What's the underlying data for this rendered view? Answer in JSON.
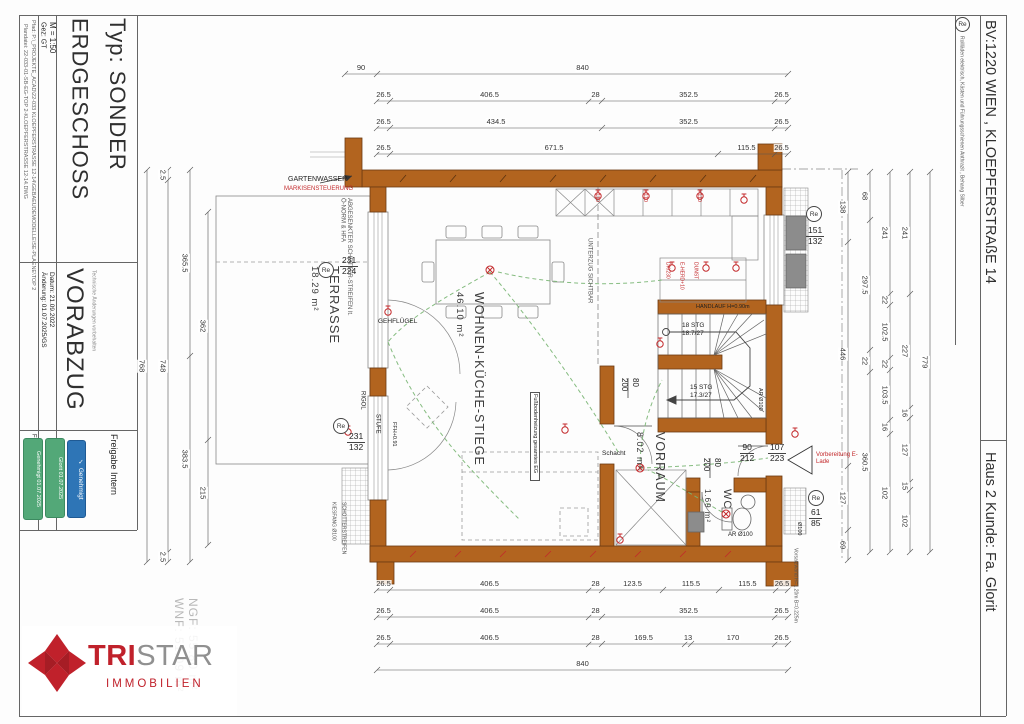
{
  "symbols": {
    "re": "Re"
  },
  "titleblock": {
    "typ": "Typ: SONDER",
    "floor": "ERDGESCHOSS",
    "scale": "M = 1:50",
    "gez": "Gez:  GT",
    "pfad": "Pfad: P:\\_PROJEKTE_ACAD\\22-033 KLOEPFERSTRASSE 12-14\\GEBAEUDEMODELLE\\SE-PLAENE\\TOP 2",
    "plandatei": "Plandatei: 22-033-01-SB-EG-TOP 2-KLOEPFERSTRASSE 12-14.DWG",
    "vorabzug": "VORABZUG",
    "vorabzug_sub": "Technische Änderungen vorbehalten",
    "datum": "Datum: 21.09.2022",
    "aenderung": "Änderung: 01.07.2025/GS",
    "freigabe_kunde": "Freigabe Kunde:",
    "freigabe_intern": "Freigabe Intern",
    "stamp_green_2": "Genehmigt 01.07.2025",
    "stamp_green_1": "Glorit 01.07.2025",
    "stamp_check": "✓",
    "stamp_blue_label": "Genehmigt"
  },
  "header_right": {
    "bv": "BV:1220 WIEN ,   KLOEPFERSTRAßE 14",
    "re_note": "Rollläden elektrisch, Kästen und Führungsschienen Anthrazit , Behang Silber",
    "haus": "Haus 2   Kunde: Fa. Glorit"
  },
  "logo": {
    "tri": "TRI",
    "star": "STAR",
    "sub": "IMMOBILIEN"
  },
  "areas": {
    "ngf": "NGF: 55.80 m²",
    "wnf": "WNF: 51.09 m²"
  },
  "rooms": {
    "terrasse": {
      "name": "TERRASSE",
      "area": "18.29 m²"
    },
    "wohnen": {
      "name": "WOHNEN-KÜCHE-STIEGE",
      "area": "46.10 m²"
    },
    "vorraum": {
      "name": "VORRAUM",
      "area": "8.02 m²"
    },
    "wc": {
      "name": "WC",
      "area": "1.69 m²"
    }
  },
  "openings": {
    "win_left_top": {
      "num": "231",
      "den": "224"
    },
    "win_left_bottom": {
      "num": "231",
      "den": "132"
    },
    "win_right_top": {
      "num": "151",
      "den": "132"
    },
    "win_right_bottom": {
      "num": "61",
      "den": "85"
    },
    "door_living": {
      "num": "80",
      "den": "200"
    },
    "door_wc": {
      "num": "80",
      "den": "200"
    },
    "door_vorraum": {
      "num": "90",
      "den": "212"
    },
    "door_entry": {
      "num": "107",
      "den": "223"
    }
  },
  "stairs": {
    "flight_up": "18 STG",
    "rise_up": "18.7/27",
    "flight_low": "15 STG",
    "rise_low": "17.3/27",
    "handlauf": "HANDLAUF  H=0.90m"
  },
  "annotations": {
    "gartenwasser": "GARTENWASSER",
    "markise": "MARKISENSTEUERUNG",
    "schotter_left": "ABGESENKTER SCHOTTER-STREIFEN lt. Ö-NORM & HFA",
    "gehfluegel": "GEHFLÜGEL",
    "rigol": "RIGOL",
    "stufe": "STUFE",
    "ffh": "FFH+0.91",
    "unterzug": "UNTERZUG SICHTBAR",
    "fbh": "Fußbodenheizung gesamtes EG",
    "schacht": "Schacht",
    "ar100_wc": "AR Ø100",
    "ar100_stair": "AR Ø100",
    "o100": "Ø100",
    "e_lade": "Vorbereitung E-Lade",
    "vorsatzwand": "Vorsatzwand H=1.20m B=0.225m",
    "kiesfang": "KIESFANG Ø100",
    "schotter_bottom": "SCHOTTERSTREIFEN",
    "plus110": "+110",
    "dk": "DK/230",
    "eherd": "E-HERD+10",
    "dunst": "DUNST"
  },
  "dims": {
    "top": [
      [
        "90",
        "840"
      ],
      [
        "26.5",
        "406.5",
        "28",
        "352.5",
        "26.5"
      ],
      [
        "26.5",
        "434.5",
        "352.5",
        "26.5"
      ],
      [
        "26.5",
        "671.5",
        "115.5",
        "26.5"
      ]
    ],
    "bottom": [
      [
        "26.5",
        "406.5",
        "28",
        "123.5",
        "115.5",
        "115.5",
        "26.5"
      ],
      [
        "26.5",
        "406.5",
        "28",
        "352.5",
        "26.5"
      ],
      [
        "26.5",
        "406.5",
        "28",
        "169.5",
        "13",
        "170",
        "26.5"
      ],
      [
        "840"
      ]
    ],
    "left": [
      [
        "768"
      ],
      [
        "2.5",
        "748",
        "2.5"
      ],
      [
        "365.5",
        "383.5"
      ],
      [
        "362",
        "215"
      ]
    ],
    "right": [
      [
        "138",
        "446",
        "127",
        "69"
      ],
      [
        "68",
        "297.5",
        "22",
        "360.5"
      ],
      [
        "241",
        "22",
        "102.5",
        "22",
        "103.5",
        "16",
        "102"
      ],
      [
        "241",
        "227",
        "16",
        "127",
        "15",
        "102"
      ],
      [
        "779"
      ]
    ]
  },
  "colors": {
    "wall": "#b2641f",
    "annotation_red": "#c3292b",
    "cable_green": "#79b573",
    "stamp_green": "#53a878",
    "stamp_blue": "#2e75b6",
    "brand_red": "#c0212b"
  }
}
